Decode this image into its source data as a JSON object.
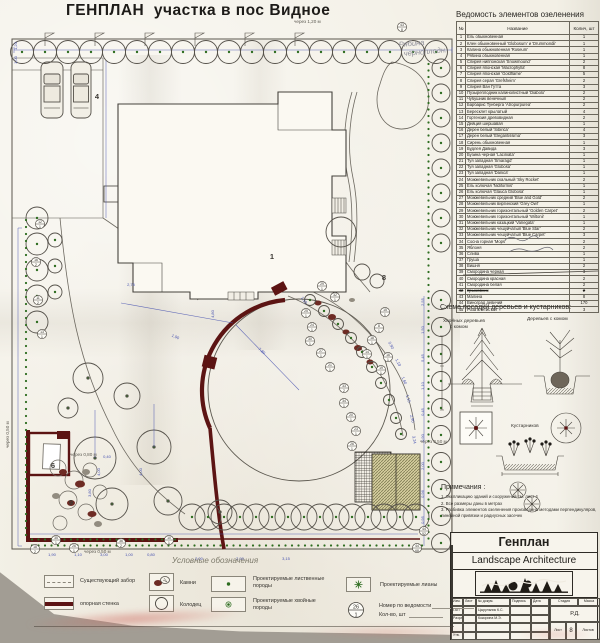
{
  "title": "ГЕНПЛАН  участка в пос Видное",
  "plan": {
    "handwriting": {
      "line1": "Рябина",
      "line2": "черноплодн."
    },
    "spacing_notes": [
      {
        "t": "через 1,20 м",
        "x": 294,
        "y": 23,
        "r": 0
      },
      {
        "t": "через 0,50 м",
        "x": 9,
        "y": 448,
        "r": -90
      },
      {
        "t": "через 0,80 м",
        "x": 70,
        "y": 456,
        "r": 0
      },
      {
        "t": "через 0,50 м",
        "x": 420,
        "y": 443,
        "r": 0
      },
      {
        "t": "через 0,50 м",
        "x": 84,
        "y": 553,
        "r": 0
      }
    ],
    "area_labels": [
      {
        "t": "4",
        "x": 97,
        "y": 99
      },
      {
        "t": "1",
        "x": 272,
        "y": 259
      },
      {
        "t": "8",
        "x": 384,
        "y": 280
      },
      {
        "t": "6",
        "x": 53,
        "y": 468
      },
      {
        "t": "9",
        "x": 71,
        "y": 505
      }
    ],
    "callouts": [
      {
        "n": "43",
        "q": "8",
        "x": 402,
        "y": 27
      },
      {
        "n": "29",
        "q": "1",
        "x": 322,
        "y": 286
      },
      {
        "n": "32",
        "q": "1",
        "x": 335,
        "y": 297
      },
      {
        "n": "25",
        "q": "1",
        "x": 306,
        "y": 313
      },
      {
        "n": "24",
        "q": "1",
        "x": 312,
        "y": 327
      },
      {
        "n": "30",
        "q": "1",
        "x": 310,
        "y": 341
      },
      {
        "n": "27",
        "q": "1",
        "x": 321,
        "y": 353
      },
      {
        "n": "21",
        "q": "1",
        "x": 330,
        "y": 367
      },
      {
        "n": "33",
        "q": "2",
        "x": 344,
        "y": 388
      },
      {
        "n": "34",
        "q": "1",
        "x": 344,
        "y": 403
      },
      {
        "n": "20",
        "q": "1",
        "x": 351,
        "y": 417
      },
      {
        "n": "23",
        "q": "1",
        "x": 356,
        "y": 431
      },
      {
        "n": "26",
        "q": "1",
        "x": 352,
        "y": 446
      },
      {
        "n": "15",
        "q": "1",
        "x": 385,
        "y": 312
      },
      {
        "n": "8",
        "q": "1",
        "x": 379,
        "y": 328
      },
      {
        "n": "18",
        "q": "1",
        "x": 372,
        "y": 340
      },
      {
        "n": "14",
        "q": "1",
        "x": 367,
        "y": 354
      },
      {
        "n": "16",
        "q": "1",
        "x": 388,
        "y": 357
      },
      {
        "n": "19",
        "q": "1",
        "x": 381,
        "y": 370
      },
      {
        "n": "12",
        "q": "1",
        "x": 40,
        "y": 224
      },
      {
        "n": "16",
        "q": "2",
        "x": 36,
        "y": 262
      },
      {
        "n": "11",
        "q": "2",
        "x": 38,
        "y": 300
      },
      {
        "n": "13",
        "q": "1",
        "x": 42,
        "y": 334
      },
      {
        "n": "18",
        "q": "2",
        "x": 35,
        "y": 549
      },
      {
        "n": "35",
        "q": "1",
        "x": 56,
        "y": 540
      },
      {
        "n": "26",
        "q": "1",
        "x": 74,
        "y": 548
      },
      {
        "n": "36",
        "q": "2",
        "x": 121,
        "y": 543
      },
      {
        "n": "10",
        "q": "1",
        "x": 169,
        "y": 540
      },
      {
        "n": "44",
        "q": "52",
        "x": 424,
        "y": 531
      },
      {
        "n": "44",
        "q": "68",
        "x": 417,
        "y": 548
      }
    ],
    "dims": [
      {
        "t": "1,20",
        "x": 17,
        "y": 46,
        "r": -90
      },
      {
        "t": "1,00",
        "x": 17,
        "y": 60,
        "r": -90
      },
      {
        "t": "2,75",
        "x": 131,
        "y": 286,
        "r": 0
      },
      {
        "t": "4,80",
        "x": 214,
        "y": 314,
        "r": -90
      },
      {
        "t": "1,90",
        "x": 175,
        "y": 338,
        "r": 22
      },
      {
        "t": "7,80",
        "x": 261,
        "y": 352,
        "r": 40
      },
      {
        "t": "1,10",
        "x": 303,
        "y": 301,
        "r": 55
      },
      {
        "t": "0,90",
        "x": 390,
        "y": 346,
        "r": 62
      },
      {
        "t": "1,10",
        "x": 397,
        "y": 363,
        "r": 64
      },
      {
        "t": "1,60",
        "x": 403,
        "y": 381,
        "r": 68
      },
      {
        "t": "1,15",
        "x": 407,
        "y": 399,
        "r": 72
      },
      {
        "t": "2,90",
        "x": 411,
        "y": 419,
        "r": 76
      },
      {
        "t": "3,24",
        "x": 413,
        "y": 440,
        "r": 80
      },
      {
        "t": "2,55",
        "x": 424,
        "y": 302,
        "r": -90
      },
      {
        "t": "1,50",
        "x": 424,
        "y": 330,
        "r": -90
      },
      {
        "t": "5,45",
        "x": 424,
        "y": 358,
        "r": -90
      },
      {
        "t": "1,10",
        "x": 424,
        "y": 386,
        "r": -90
      },
      {
        "t": "0,45",
        "x": 424,
        "y": 412,
        "r": -90
      },
      {
        "t": "0,90",
        "x": 424,
        "y": 438,
        "r": -90
      },
      {
        "t": "2,00",
        "x": 424,
        "y": 466,
        "r": -90
      },
      {
        "t": "0,96",
        "x": 424,
        "y": 494,
        "r": -90
      },
      {
        "t": "0,95",
        "x": 424,
        "y": 520,
        "r": -90
      },
      {
        "t": "4,00",
        "x": 100,
        "y": 472,
        "r": -90
      },
      {
        "t": "4,00",
        "x": 142,
        "y": 472,
        "r": -90
      },
      {
        "t": "3,80",
        "x": 91,
        "y": 493,
        "r": -90
      },
      {
        "t": "0,40",
        "x": 107,
        "y": 458,
        "r": 0
      },
      {
        "t": "1,90",
        "x": 52,
        "y": 556,
        "r": 0
      },
      {
        "t": "1,10",
        "x": 78,
        "y": 556,
        "r": 0
      },
      {
        "t": "3,00",
        "x": 104,
        "y": 556,
        "r": 0
      },
      {
        "t": "1,00",
        "x": 129,
        "y": 556,
        "r": 0
      },
      {
        "t": "0,80",
        "x": 151,
        "y": 556,
        "r": 0
      },
      {
        "t": "2,00",
        "x": 199,
        "y": 560,
        "r": 0
      },
      {
        "t": "2,90",
        "x": 240,
        "y": 560,
        "r": 0
      },
      {
        "t": "3,15",
        "x": 286,
        "y": 560,
        "r": 0
      }
    ]
  },
  "table": {
    "title": "Ведомость элементов озеленения",
    "columns": {
      "num": "№",
      "name": "Название",
      "qty": "Колич, шт"
    },
    "rows": [
      [
        1,
        "Ель обыкновенная",
        "1",
        false
      ],
      [
        2,
        "Клен обыкновенный 'Globosum' и 'Drummondii'",
        "1",
        false
      ],
      [
        3,
        "Калина обыкновенная 'Roseum'",
        "1",
        false
      ],
      [
        4,
        "Рябина обыкновенная",
        "1",
        false
      ],
      [
        5,
        "Спирея ниппонская 'Snowmound'",
        "2",
        false
      ],
      [
        6,
        "Спирея японская 'Macrophylla'",
        "8",
        false
      ],
      [
        7,
        "Спирея японская 'Goldflame'",
        "5",
        false
      ],
      [
        8,
        "Спирея серая 'Grefsheim'",
        "2",
        false
      ],
      [
        9,
        "Спирея Ван Гутта",
        "3",
        false
      ],
      [
        10,
        "Пузыреплодник калинолистный 'Diabolo'",
        "2",
        false
      ],
      [
        11,
        "Чубушник венечный",
        "2",
        false
      ],
      [
        12,
        "Барбарис Тунберга 'Atropurpurea'",
        "2",
        false
      ],
      [
        13,
        "Бересклет крылатый",
        "4",
        false
      ],
      [
        14,
        "Гортензия древовидная",
        "2",
        false
      ],
      [
        15,
        "Дейция шершавая",
        "1",
        false
      ],
      [
        16,
        "Дерен белый 'Sibirica'",
        "4",
        false
      ],
      [
        17,
        "Дерен белый 'Elegantissima'",
        "3",
        false
      ],
      [
        18,
        "Сирень обыкновенная",
        "1",
        false
      ],
      [
        19,
        "Будлея Давида",
        "3",
        false
      ],
      [
        20,
        "Бузина черная 'Laciniata'",
        "1",
        false
      ],
      [
        21,
        "Туя западная 'Smaragd'",
        "1",
        false
      ],
      [
        22,
        "Туя западная 'Globosa'",
        "1",
        false
      ],
      [
        23,
        "Туя западная 'Danica'",
        "1",
        false
      ],
      [
        24,
        "Можжевельник скальный 'Sky Rocket'",
        "2",
        false
      ],
      [
        25,
        "Ель колючая 'Nidiformis'",
        "1",
        false
      ],
      [
        26,
        "Ель колючая 'Glauca Globosa'",
        "1",
        false
      ],
      [
        27,
        "Можжевельник средний 'Blue and Gold'",
        "2",
        false
      ],
      [
        28,
        "Можжевельник виргинский 'Grey Owl'",
        "1",
        false
      ],
      [
        29,
        "Можжевельник горизонтальный 'Golden Carpet'",
        "2",
        false
      ],
      [
        30,
        "Можжевельник горизонтальный 'Wiltonii'",
        "1",
        false
      ],
      [
        31,
        "Можжевельник казацкий 'Variegata'",
        "1",
        false
      ],
      [
        32,
        "Можжевельник чешуйчатый 'Blue Star'",
        "2",
        false
      ],
      [
        33,
        "Можжевельник чешуйчатый 'Blue Carpet'",
        "3",
        false
      ],
      [
        34,
        "Сосна горная 'Mops'",
        "2",
        false
      ],
      [
        35,
        "Яблоня",
        "2",
        false
      ],
      [
        36,
        "Слива",
        "1",
        false
      ],
      [
        37,
        "Груша",
        "1",
        false
      ],
      [
        38,
        "Вишня",
        "2",
        false
      ],
      [
        39,
        "Смородина черная",
        "3",
        false
      ],
      [
        40,
        "Смородина красная",
        "2",
        false
      ],
      [
        41,
        "Смородина белая",
        "2",
        false
      ],
      [
        42,
        "Крыжовник",
        "2",
        true
      ],
      [
        43,
        "Малина",
        "8",
        false
      ],
      [
        44,
        "Виноград девичий",
        "170",
        false
      ],
      [
        45,
        "Роза плетистая",
        "3",
        false
      ]
    ]
  },
  "scheme": {
    "title": "Схема посадки деревьев и кустарников:",
    "label_conifer_1": "Хвойных деревьев",
    "label_conifer_2": "с комом",
    "label_deciduous": "Деревьев с комом",
    "label_shrubs": "Кустарников"
  },
  "notes": {
    "title": "Примечания :",
    "items": [
      "1. Экспликацию зданий и сооружений см. лист 4",
      "2. Все размеры даны в метрах",
      "3. Разбивка элементов озеленения произведена методами перпендикуляров, линейной привязки и радиусных засечек"
    ]
  },
  "legend": {
    "title": "Условные обозначения",
    "fence": "Существующий забор",
    "wall": "опорная стенка",
    "stones": "Камни",
    "well": "Колодец",
    "deciduous1": "Проектируемые лиственные",
    "deciduous2": "породы",
    "conifer1": "Проектируемые хвойные",
    "conifer2": "породы",
    "lianas": "Проектируемые лианы",
    "callout_line1": "Номер по ведомости",
    "callout_line2": "Кол-во, шт",
    "callout_top": "26",
    "callout_bottom": "1"
  },
  "titleblock": {
    "title": "Генплан",
    "subtitle": "Landscape Architecture",
    "cols": [
      "Изм.",
      "Лист",
      "№ докум.",
      "Подпись",
      "Дата"
    ],
    "row1_role": "ГАП",
    "row1_name": "Цырульник К.С.",
    "row2_role": "Разраб.",
    "row2_name": "Кокорина М.Э.",
    "row3_role": "Утв.",
    "stage_label": "Стадия",
    "mass_label": "Масса",
    "stage": "Р.Д.",
    "sheet_label": "Лист",
    "sheet": "8",
    "sheets_label": "Листов"
  },
  "colors": {
    "wall": "#5c1413",
    "dot": "#2e6d20",
    "dim": "#4752b0"
  }
}
